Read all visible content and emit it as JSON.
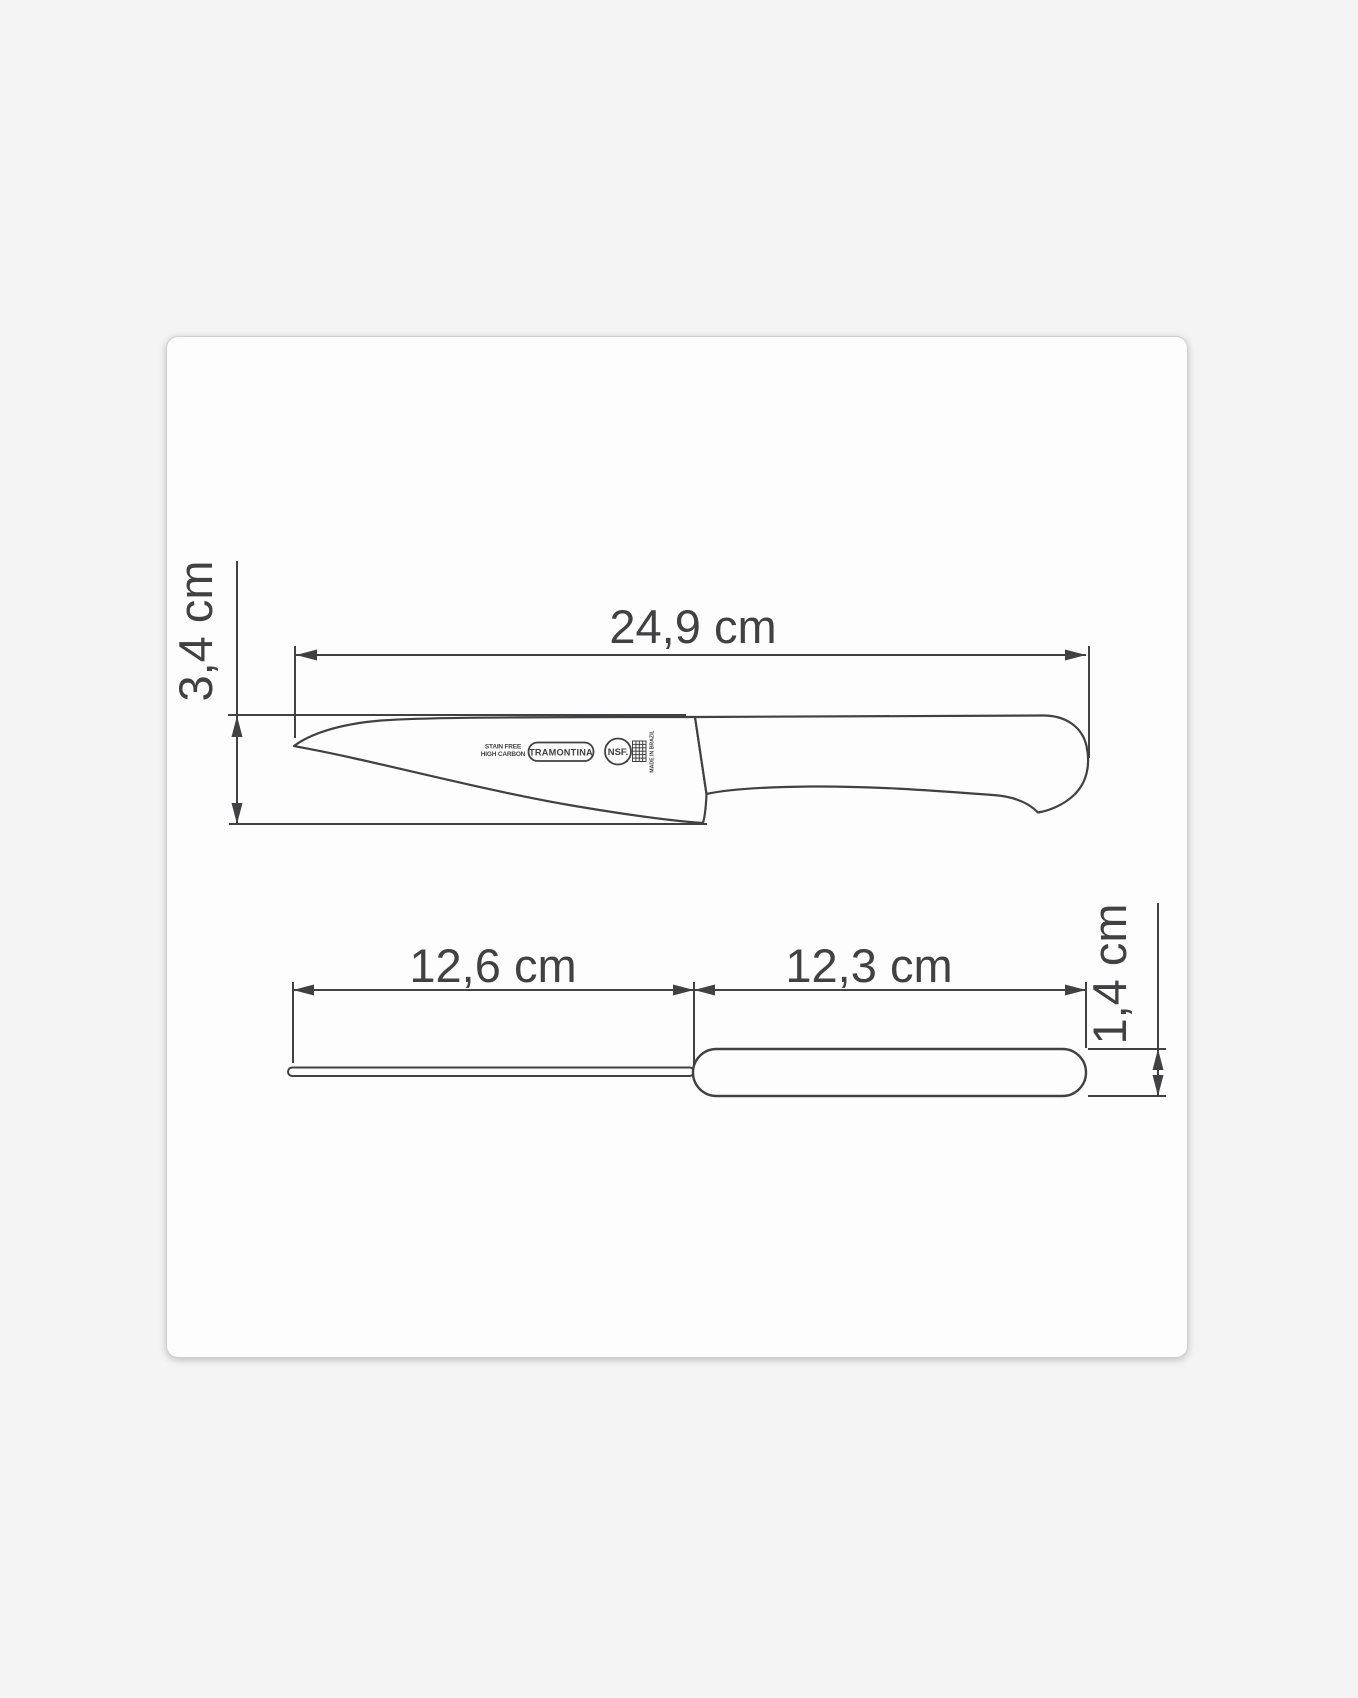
{
  "page": {
    "background_color": "#f4f4f5"
  },
  "card": {
    "background_color": "#fdfdfd",
    "border_color": "#cfcfd1"
  },
  "diagram": {
    "line_color": "#414143",
    "text_color": "#414143",
    "side_view": {
      "total_length_label": "24,9 cm",
      "blade_height_label": "3,4 cm"
    },
    "top_view": {
      "blade_length_label": "12,6 cm",
      "handle_length_label": "12,3 cm",
      "handle_width_label": "1,4 cm"
    },
    "blade_stamp": {
      "micro_line_1": "STAIN FREE",
      "micro_line_2": "HIGH CARBON",
      "brand": "TRAMONTINA",
      "certification": "NSF.",
      "origin": "MADE IN BRAZIL"
    }
  }
}
